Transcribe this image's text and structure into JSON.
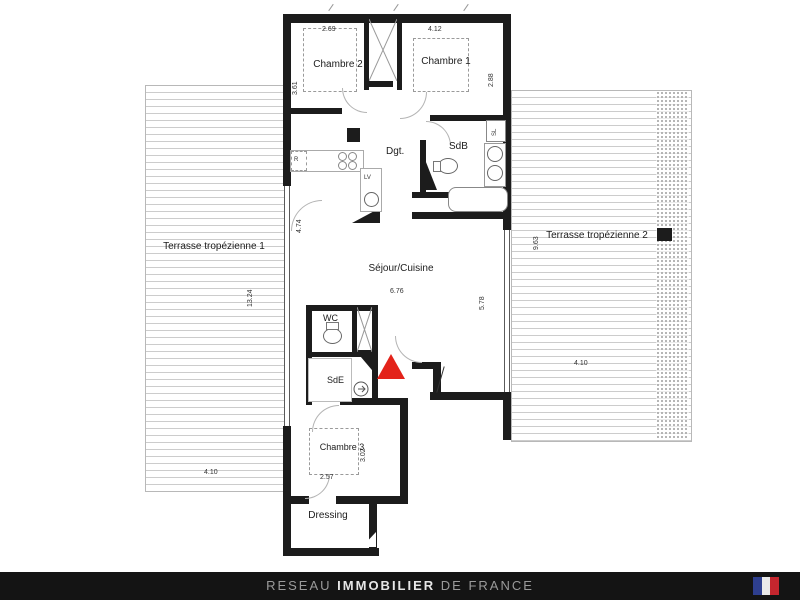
{
  "plan": {
    "rooms": {
      "chambre2": {
        "label": "Chambre 2",
        "width": "2.69",
        "height": "3.61"
      },
      "chambre1": {
        "label": "Chambre 1",
        "width": "4.12",
        "height": "2.88"
      },
      "chambre3": {
        "label": "Chambre 3",
        "width": "2.57",
        "height": "3.02"
      },
      "sejour": {
        "label": "Séjour/Cuisine",
        "width": "6.76",
        "height": "5.78",
        "kitchen_depth": "4.74"
      },
      "dgt": {
        "label": "Dgt."
      },
      "sdb": {
        "label": "SdB"
      },
      "sde": {
        "label": "SdE"
      },
      "wc": {
        "label": "WC"
      },
      "dressing": {
        "label": "Dressing"
      },
      "terrasse1": {
        "label": "Terrasse tropézienne 1",
        "height": "13.24",
        "width": "4.10"
      },
      "terrasse2": {
        "label": "Terrasse tropézienne 2",
        "height": "9.63",
        "width": "4.10"
      }
    },
    "appliances": {
      "refrigerator": "R",
      "dishwasher": "LV",
      "dryer": "SL"
    },
    "entrance_marker_color": "#e3231a"
  },
  "footer": {
    "brand_prefix": "RESEAU",
    "brand_emphasis": "IMMOBILIER",
    "brand_suffix": "DE FRANCE",
    "flag": {
      "blue": "#2e3f8f",
      "white": "#e9e9e9",
      "red": "#c4262e"
    }
  }
}
